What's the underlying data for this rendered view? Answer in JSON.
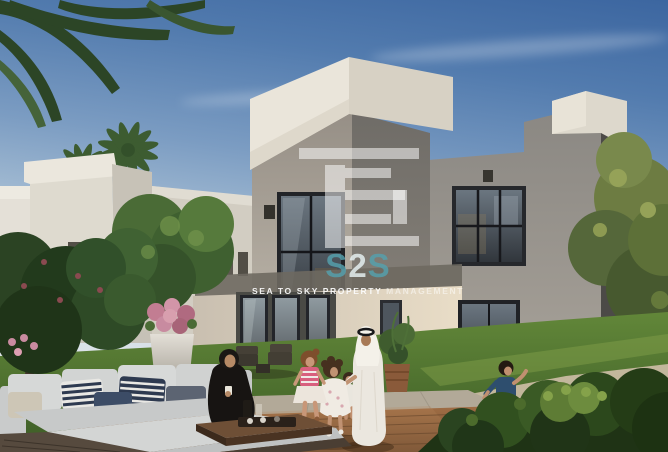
{
  "meta": {
    "description": "Architectural rendering: modern two-storey grey villa with white parapets, garden lawn, wooden deck, outdoor sofa and an Emirati family (seated woman, standing man in kandura, three children, running boy)"
  },
  "watermark": {
    "s1": "S",
    "s2": "2",
    "s3": "S",
    "tagline_bold": "SEA TO SKY PROPERTY",
    "tagline_light": "MANAGEMENT",
    "teal": "#55a1ae",
    "white": "#ffffff",
    "logo_mark": "s2s-bars-logo"
  },
  "palette": {
    "sky_top": "#3c66a0",
    "sky_horizon": "#e9ebed",
    "villa_white_cap": "#eae5da",
    "villa_gray_front": "#968f86",
    "villa_gray_side": "#6f6c67",
    "villa_dark_side": "#4c4a47",
    "glass_dark": "#26282c",
    "lawn_green": "#628739",
    "hedge_dark": "#1f3315",
    "deck_wood": "#a06e45",
    "sofa_cushion": "#d4d6d5",
    "pillow_navy": "#2e3a50",
    "kandura_white": "#ebe7df",
    "abaya_black": "#171412",
    "tshirt_blue": "#2e4e6e",
    "dress_pink": "#d85f7e",
    "flower_pink": "#c27d92",
    "pot_terracotta": "#8a5a3a"
  },
  "scene": {
    "elements": [
      "palm-fronds",
      "neighbor-villas",
      "palm-trees",
      "main-villa",
      "tower-window",
      "wing-window",
      "glass-doors",
      "wall-lamps",
      "garden-lawn",
      "stone-patio",
      "wood-deck",
      "outdoor-sofa",
      "striped-pillows",
      "coffee-table",
      "flower-planter",
      "potted-plant",
      "patio-chairs",
      "garden-trees",
      "front-hedge",
      "seated-woman",
      "standing-man",
      "girl-striped-dress",
      "girl-white-dress",
      "toddler",
      "running-boy"
    ]
  }
}
